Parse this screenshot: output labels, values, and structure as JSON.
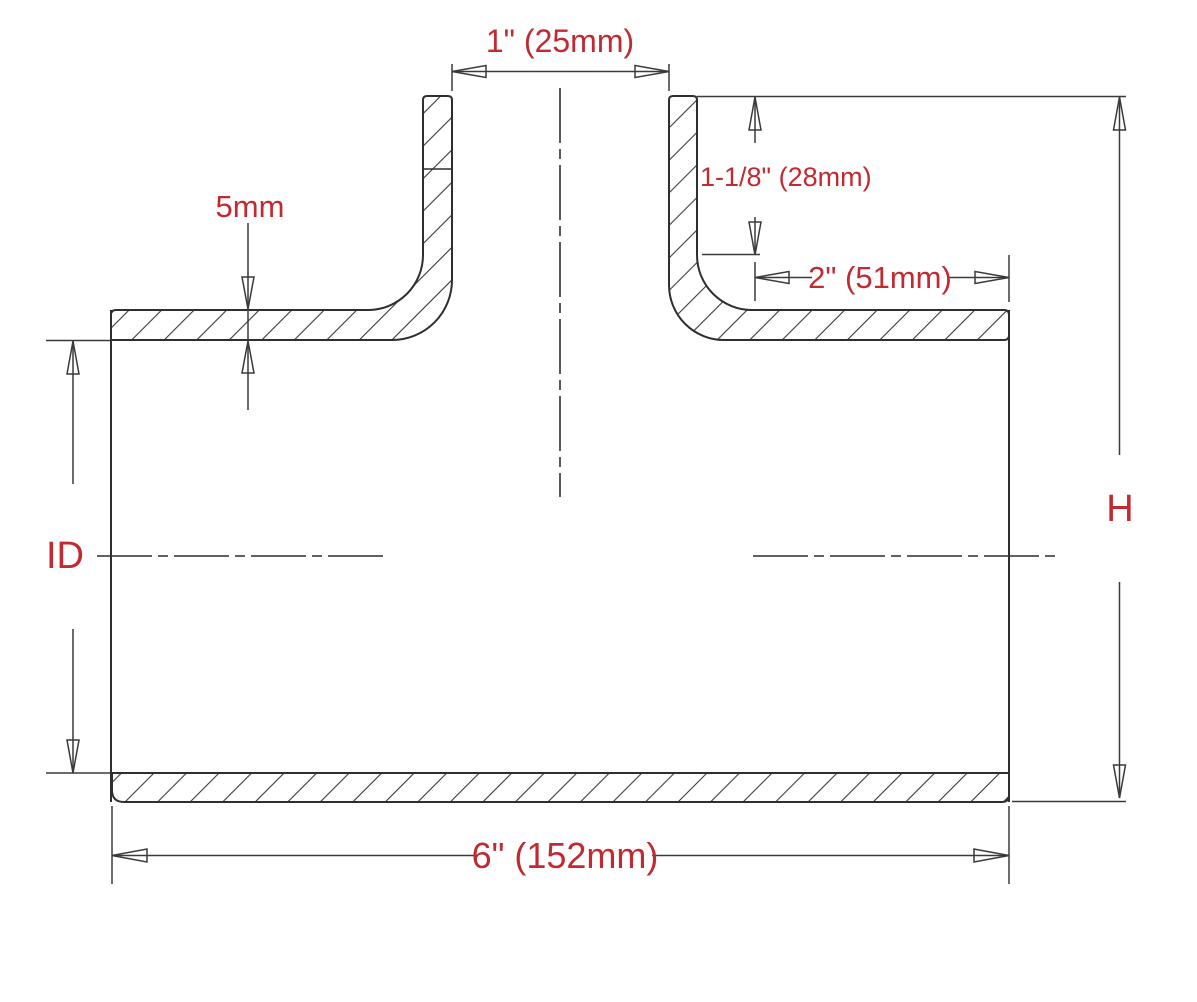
{
  "drawing": {
    "kind": "tee-coupler-cross-section",
    "labels": {
      "branch_id": "1\" (25mm)",
      "branch_length": "1-1/8\" (28mm)",
      "right_leg_length": "2\" (51mm)",
      "wall_thickness": "5mm",
      "inner_diameter": "ID",
      "overall_height": "H",
      "overall_length": "6\" (152mm)"
    },
    "colors": {
      "label_text": "#c02a30",
      "line": "#2f2f2f",
      "dimension_line": "#3a3a3a",
      "background": "#ffffff"
    }
  }
}
